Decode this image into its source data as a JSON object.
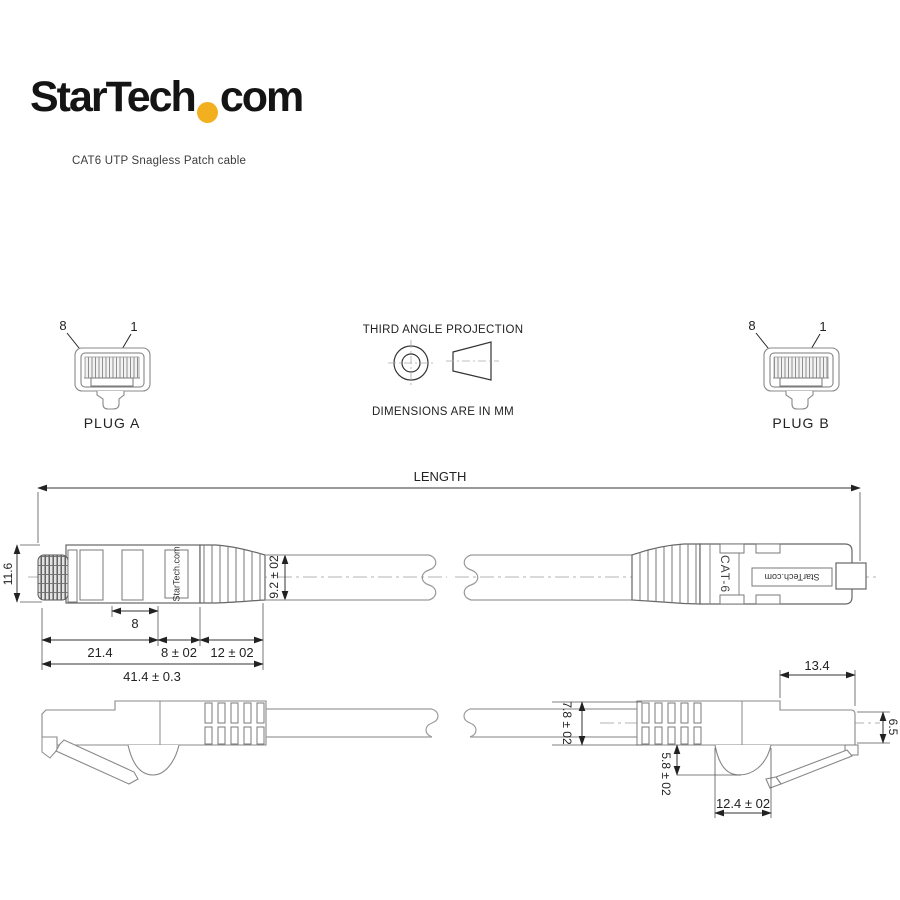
{
  "page": {
    "background": "#ffffff"
  },
  "brand": {
    "logo_start": "StarTech",
    "logo_end": "com",
    "logo_dot_color": "#F2B01E",
    "subtitle": "CAT6 UTP Snagless Patch cable"
  },
  "plug_a": {
    "pin8": "8",
    "pin1": "1",
    "caption": "PLUG A"
  },
  "plug_b": {
    "pin8": "8",
    "pin1": "1",
    "caption": "PLUG B"
  },
  "projection": {
    "title": "THIRD ANGLE PROJECTION",
    "note": "DIMENSIONS ARE IN MM"
  },
  "drawing": {
    "length_label": "LENGTH",
    "marks": {
      "startech_left": "StarTech.com",
      "startech_right": "StarTech.com",
      "cat6": "CAT-6"
    },
    "dims": {
      "plug_height": "11.6",
      "window": "8",
      "body_len": "21.4",
      "boot1": "8 ± 02",
      "boot2": "12 ± 02",
      "overall": "41.4 ± 0.3",
      "boot_od": "9.2 ± 02",
      "cable_od": "7.8 ± 02",
      "front_len": "13.4",
      "tip_h": "6.5",
      "tab_depth": "5.8 ± 02",
      "tab_width": "12.4 ± 02"
    }
  }
}
